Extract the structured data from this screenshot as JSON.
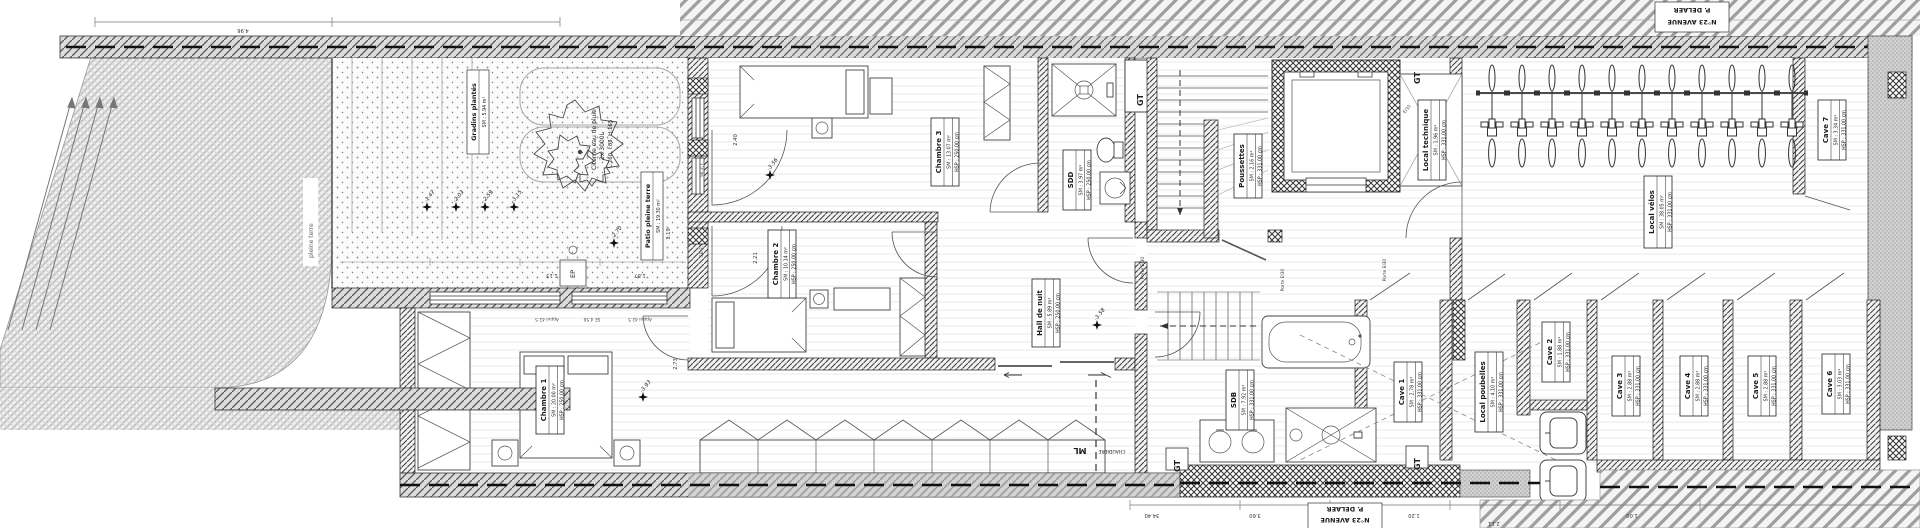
{
  "street": {
    "avenue_box": {
      "line1": "N°23 AVENUE",
      "line2": "P. DELAER"
    }
  },
  "site": {
    "parcel_label": "pleine terre",
    "gradins": {
      "name": "Gradins plantés",
      "area": "SM : 5.94 m²"
    },
    "patio": {
      "name": "Patio pleine terre",
      "area": "SM : 19.30 m²"
    },
    "cistern": {
      "line1": "Citerne eau de pluie",
      "line2": "2x 3000L",
      "line3": "L:260, l:88, H:165"
    },
    "ep_label": "EP"
  },
  "rooms": {
    "chambre1": {
      "name": "Chambre 1",
      "area": "SM : 20.00 m²",
      "height": "HSP : 250.00 cm"
    },
    "chambre2": {
      "name": "Chambre 2",
      "area": "SM : 10.14 m²",
      "height": "HSP : 250.00 cm"
    },
    "chambre3": {
      "name": "Chambre 3",
      "area": "SM : 13.07 m²",
      "height": "HSP : 250.00 cm"
    },
    "sdd": {
      "name": "SDD",
      "area": "SM : 3.97 m²",
      "height": "HSP : 250.00 cm"
    },
    "sdb": {
      "name": "SDB",
      "area": "SM : 7.92 m²",
      "height": "HSP : 331.00 cm"
    },
    "hall_de_nuit": {
      "name": "Hall de nuit",
      "area": "SM : 5.89 m²",
      "height": "HSP : 250.00 cm"
    },
    "poussettes": {
      "name": "Poussettes",
      "area": "SM : 2.16 m²",
      "height": "HSP : 331.00 cm"
    },
    "local_technique": {
      "name": "Local technique",
      "area": "SM : 1.96 m²",
      "height": "HSP : 331.00 cm"
    },
    "local_velos": {
      "name": "Local vélos",
      "area": "SM : 38.05 m²",
      "height": "HSP : 331.00 cm",
      "bike_count": 11
    },
    "local_poubelles": {
      "name": "Local poubelles",
      "area": "SM : 4.10 m²",
      "height": "HSP : 331.00 cm"
    },
    "cave1": {
      "name": "Cave 1",
      "area": "SM : 2.78 m²",
      "height": "HSP : 331.00 cm"
    },
    "cave2": {
      "name": "Cave 2",
      "area": "SM : 1.88 m²",
      "height": "HSP : 331.00 cm"
    },
    "cave3": {
      "name": "Cave 3",
      "area": "SM : 2.88 m²",
      "height": "HSP : 331.00 cm"
    },
    "cave4": {
      "name": "Cave 4",
      "area": "SM : 2.88 m²",
      "height": "HSP : 331.00 cm"
    },
    "cave5": {
      "name": "Cave 5",
      "area": "SM : 2.88 m²",
      "height": "HSP : 331.00 cm"
    },
    "cave6": {
      "name": "Cave 6",
      "area": "SM : 3.03 m²",
      "height": "HSP : 331.00 cm"
    },
    "cave7": {
      "name": "Cave 7",
      "area": "SM : 3.34 m²",
      "height": "HSP : 331.00 cm"
    }
  },
  "annotations": {
    "gt": "GT",
    "ml": "ML",
    "chaudiere": "CHAUDIERE",
    "porte_ei30": "Porte EI30",
    "ei30": "EI30",
    "sills": [
      "Appui 42.5",
      "SE 4.56",
      "Appui 42.5"
    ],
    "windows": [
      "SE 2,7",
      "SE 2,3"
    ],
    "levels": [
      "-1.47",
      "-2.03",
      "-2.59",
      "-3.15",
      "-2.70",
      "-3.56",
      "-3.58",
      "-3.93"
    ],
    "dims_top": [
      "4.96"
    ],
    "dims_bottom": [
      "34.40",
      "3.60",
      "1.20",
      "2.11",
      "1.00"
    ],
    "dims_interior": [
      "2.40",
      "2.21",
      "2.73",
      "1.19",
      "1.87",
      "1.13"
    ]
  }
}
